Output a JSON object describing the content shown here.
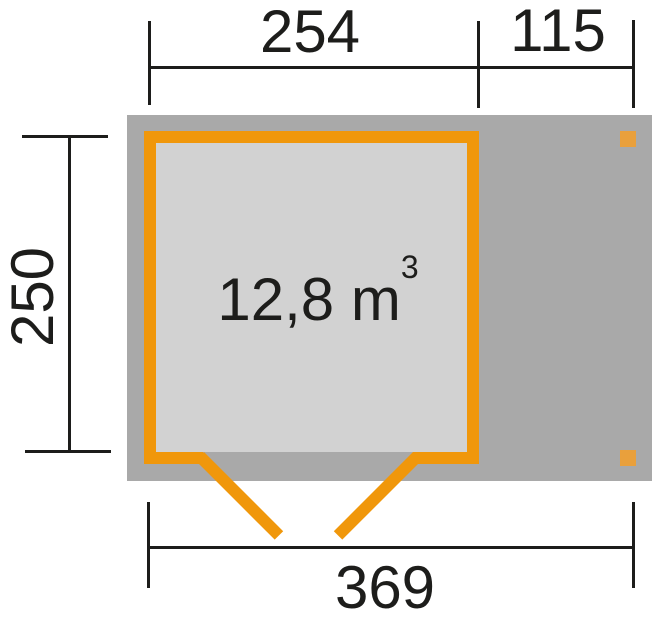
{
  "colors": {
    "orange": "#F0970B",
    "post_orange": "#E9A03C",
    "footprint_gray": "#A9A9A9",
    "interior_gray": "#D2D2D2",
    "line_black": "#1D1D1B",
    "background": "#FFFFFF"
  },
  "plan": {
    "volume": {
      "value": "12,8 m",
      "sup": "3"
    },
    "dimensions": {
      "top_main": "254",
      "top_side": "115",
      "left": "250",
      "bottom": "369"
    }
  }
}
